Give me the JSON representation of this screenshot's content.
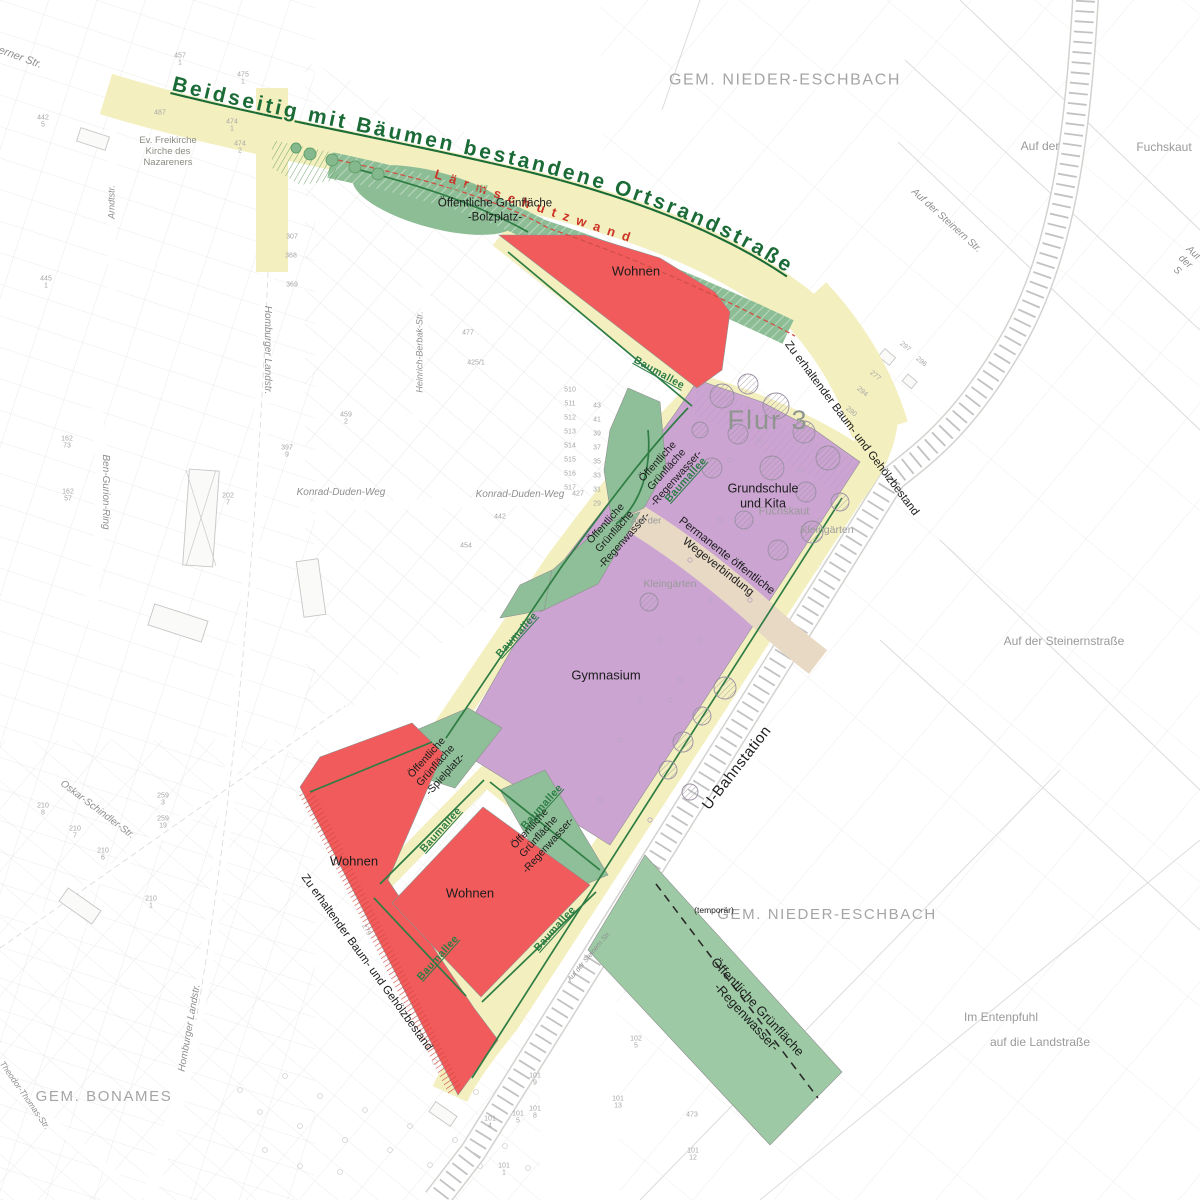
{
  "colors": {
    "road": "#f3efbf",
    "green_zone": "#8fbf98",
    "green_band": "#9dcaa5",
    "residential_red": "#f15b5b",
    "school_purple": "#cba4d2",
    "path_beige": "#e8d9c4",
    "title_green": "#1a6b36",
    "noise_red": "#cc3326",
    "allee_green": "#2e7d46",
    "gray_text": "#9a9a9a"
  },
  "curved": {
    "ortsrand": "Beidseitig mit Bäumen bestandene Ortsrandstraße",
    "laermschutz": "L ä r m s c h u t z w a n d"
  },
  "municipalities": {
    "nieder_eschbach": "GEM. NIEDER-ESCHBACH",
    "bonames": "GEM. BONAMES"
  },
  "zones": {
    "flur": "Flur 3",
    "wohnen": "Wohnen",
    "gymnasium": "Gymnasium",
    "grundschule": "Grundschule\nund Kita",
    "og_bolzplatz": "Öffentliche Grünfläche\n-Bolzplatz-",
    "bolzplatz": "Bolzplatz",
    "og_regen3": "Öffentliche\nGrünfläche\n-Regenwasser-",
    "og_spielplatz3": "Öffentliche\nGrünfläche\n-Spielplatz-",
    "og_regen_band": "Öffentliche Grünfläche\n-Regenwasser-",
    "temporaer": "(temporär)",
    "kleingaerten": "Kleingärten",
    "fuchskaut": "Fuchskaut",
    "permanente": "Permanente öffentliche\nWegeverbindung",
    "zu_erhaltender": "Zu erhaltender Baum- und Gehölzbestand",
    "u_bahn": "U-Bahnstation"
  },
  "pois": {
    "kirche": "Ev. Freikirche\nKirche des\nNazareners"
  },
  "baumallee": {
    "label": "Baumallee",
    "positions": [
      {
        "x": 659,
        "y": 373,
        "r": 29
      },
      {
        "x": 686,
        "y": 480,
        "r": -48
      },
      {
        "x": 517,
        "y": 635,
        "r": -48
      },
      {
        "x": 441,
        "y": 830,
        "r": -48
      },
      {
        "x": 542,
        "y": 807,
        "r": -48
      },
      {
        "x": 438,
        "y": 958,
        "r": -48
      },
      {
        "x": 555,
        "y": 929,
        "r": -48
      }
    ]
  },
  "streets": [
    {
      "t": "erner Str.",
      "x": 20,
      "y": 58,
      "r": 20,
      "s": 11
    },
    {
      "t": "Arndtstr.",
      "x": 112,
      "y": 202,
      "r": -90,
      "s": 9
    },
    {
      "t": "Homburger Landstr.",
      "x": 267,
      "y": 350,
      "r": 90,
      "s": 10
    },
    {
      "t": "Homburger Landstr.",
      "x": 190,
      "y": 1028,
      "r": -80,
      "s": 10
    },
    {
      "t": "Ben-Gurion-Ring",
      "x": 105,
      "y": 492,
      "r": 90,
      "s": 10
    },
    {
      "t": "Oskar-Schindler-Str.",
      "x": 97,
      "y": 810,
      "r": 37,
      "s": 10
    },
    {
      "t": "Konrad-Duden-Weg",
      "x": 341,
      "y": 493,
      "r": 0,
      "s": 10
    },
    {
      "t": "Konrad-Duden-Weg",
      "x": 520,
      "y": 495,
      "r": 0,
      "s": 10
    },
    {
      "t": "Heinrich-Berbak-Str.",
      "x": 420,
      "y": 352,
      "r": -90,
      "s": 9
    },
    {
      "t": "Auf der Steinern Str.",
      "x": 946,
      "y": 221,
      "r": 42,
      "s": 10
    },
    {
      "t": "Auf der Steinern Str.",
      "x": 590,
      "y": 957,
      "r": -50,
      "s": 7
    },
    {
      "t": "Auf der",
      "x": 1040,
      "y": 146,
      "r": 0,
      "s": 12
    },
    {
      "t": "Fuchskaut",
      "x": 1164,
      "y": 147,
      "r": 0,
      "s": 12
    },
    {
      "t": "Auf der Steinernstraße",
      "x": 1064,
      "y": 641,
      "r": 0,
      "s": 12
    },
    {
      "t": "Im Entenpfuhl",
      "x": 1001,
      "y": 1017,
      "r": 0,
      "s": 12
    },
    {
      "t": "auf die Landstraße",
      "x": 1040,
      "y": 1042,
      "r": 0,
      "s": 12
    },
    {
      "t": "Theodor-Thomas-Str.",
      "x": 25,
      "y": 1095,
      "r": 55,
      "s": 8.5
    },
    {
      "t": "Auf der S",
      "x": 1185,
      "y": 262,
      "r": 42,
      "s": 10
    },
    {
      "t": "Auf der",
      "x": 646,
      "y": 521,
      "r": 0,
      "s": 9.5
    }
  ],
  "parcels": [
    {
      "t": "457\n1",
      "x": 180,
      "y": 60
    },
    {
      "t": "475\n1",
      "x": 243,
      "y": 79
    },
    {
      "t": "474\n1",
      "x": 232,
      "y": 126
    },
    {
      "t": "474\n2",
      "x": 240,
      "y": 148
    },
    {
      "t": "487",
      "x": 160,
      "y": 113
    },
    {
      "t": "442\n5",
      "x": 43,
      "y": 122
    },
    {
      "t": "445\n1",
      "x": 46,
      "y": 283
    },
    {
      "t": "307",
      "x": 292,
      "y": 237
    },
    {
      "t": "368",
      "x": 291,
      "y": 256
    },
    {
      "t": "369",
      "x": 292,
      "y": 285
    },
    {
      "t": "202\n7",
      "x": 228,
      "y": 500
    },
    {
      "t": "397\n9",
      "x": 287,
      "y": 452
    },
    {
      "t": "162\n73",
      "x": 67,
      "y": 443
    },
    {
      "t": "162\n57",
      "x": 68,
      "y": 496
    },
    {
      "t": "477",
      "x": 468,
      "y": 333
    },
    {
      "t": "425/1",
      "x": 476,
      "y": 363
    },
    {
      "t": "427",
      "x": 578,
      "y": 494
    },
    {
      "t": "442",
      "x": 500,
      "y": 517
    },
    {
      "t": "454",
      "x": 466,
      "y": 546
    },
    {
      "t": "459\n2",
      "x": 346,
      "y": 419
    },
    {
      "t": "510",
      "x": 570,
      "y": 390
    },
    {
      "t": "511",
      "x": 570,
      "y": 404
    },
    {
      "t": "512",
      "x": 570,
      "y": 418
    },
    {
      "t": "513",
      "x": 570,
      "y": 432
    },
    {
      "t": "514",
      "x": 570,
      "y": 446
    },
    {
      "t": "515",
      "x": 570,
      "y": 460
    },
    {
      "t": "516",
      "x": 570,
      "y": 474
    },
    {
      "t": "517",
      "x": 570,
      "y": 488
    },
    {
      "t": "43",
      "x": 597,
      "y": 406
    },
    {
      "t": "41",
      "x": 597,
      "y": 420
    },
    {
      "t": "39",
      "x": 597,
      "y": 434
    },
    {
      "t": "37",
      "x": 597,
      "y": 448
    },
    {
      "t": "35",
      "x": 597,
      "y": 462
    },
    {
      "t": "33",
      "x": 597,
      "y": 476
    },
    {
      "t": "31",
      "x": 597,
      "y": 490
    },
    {
      "t": "29",
      "x": 597,
      "y": 504
    },
    {
      "t": "294",
      "x": 862,
      "y": 392,
      "r": 40
    },
    {
      "t": "290",
      "x": 851,
      "y": 412,
      "r": 40
    },
    {
      "t": "297",
      "x": 905,
      "y": 347,
      "r": 40
    },
    {
      "t": "296",
      "x": 921,
      "y": 362,
      "r": 40
    },
    {
      "t": "277",
      "x": 875,
      "y": 376,
      "r": 40
    },
    {
      "t": "279",
      "x": 366,
      "y": 930,
      "r": 60
    },
    {
      "t": "259\n3",
      "x": 163,
      "y": 800
    },
    {
      "t": "259\n19",
      "x": 163,
      "y": 823
    },
    {
      "t": "210\n8",
      "x": 43,
      "y": 810
    },
    {
      "t": "210\n7",
      "x": 75,
      "y": 833
    },
    {
      "t": "210\n6",
      "x": 103,
      "y": 855
    },
    {
      "t": "210\n1",
      "x": 151,
      "y": 903
    },
    {
      "t": "101\n4",
      "x": 490,
      "y": 1123
    },
    {
      "t": "101\n5",
      "x": 518,
      "y": 1118
    },
    {
      "t": "101\n8",
      "x": 535,
      "y": 1113
    },
    {
      "t": "101\n9",
      "x": 535,
      "y": 1080
    },
    {
      "t": "101\n13",
      "x": 618,
      "y": 1103
    },
    {
      "t": "102\n5",
      "x": 636,
      "y": 1043
    },
    {
      "t": "101\n12",
      "x": 693,
      "y": 1155
    },
    {
      "t": "101\n1",
      "x": 504,
      "y": 1170
    },
    {
      "t": "473",
      "x": 692,
      "y": 1115
    }
  ]
}
